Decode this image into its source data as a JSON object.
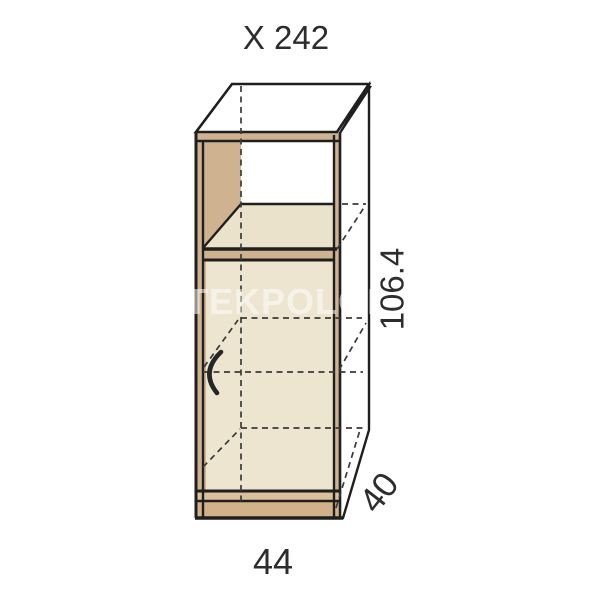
{
  "title": "X 242",
  "watermark": "TEKPOLON",
  "dimensions": {
    "height_label": "106.4",
    "depth_label": "40",
    "width_label": "44"
  },
  "colors": {
    "outline": "#1f1f1f",
    "wood_top": "#d4b997",
    "wood_side": "#cdb08c",
    "wood_frame": "#cfb28f",
    "shelf_surface": "#eae2cb",
    "door": "#ede5d0",
    "plinth_upper": "#dbc09c",
    "plinth_lower": "#d2b289",
    "niche_opening": "#ffffff",
    "background": "#ffffff"
  }
}
